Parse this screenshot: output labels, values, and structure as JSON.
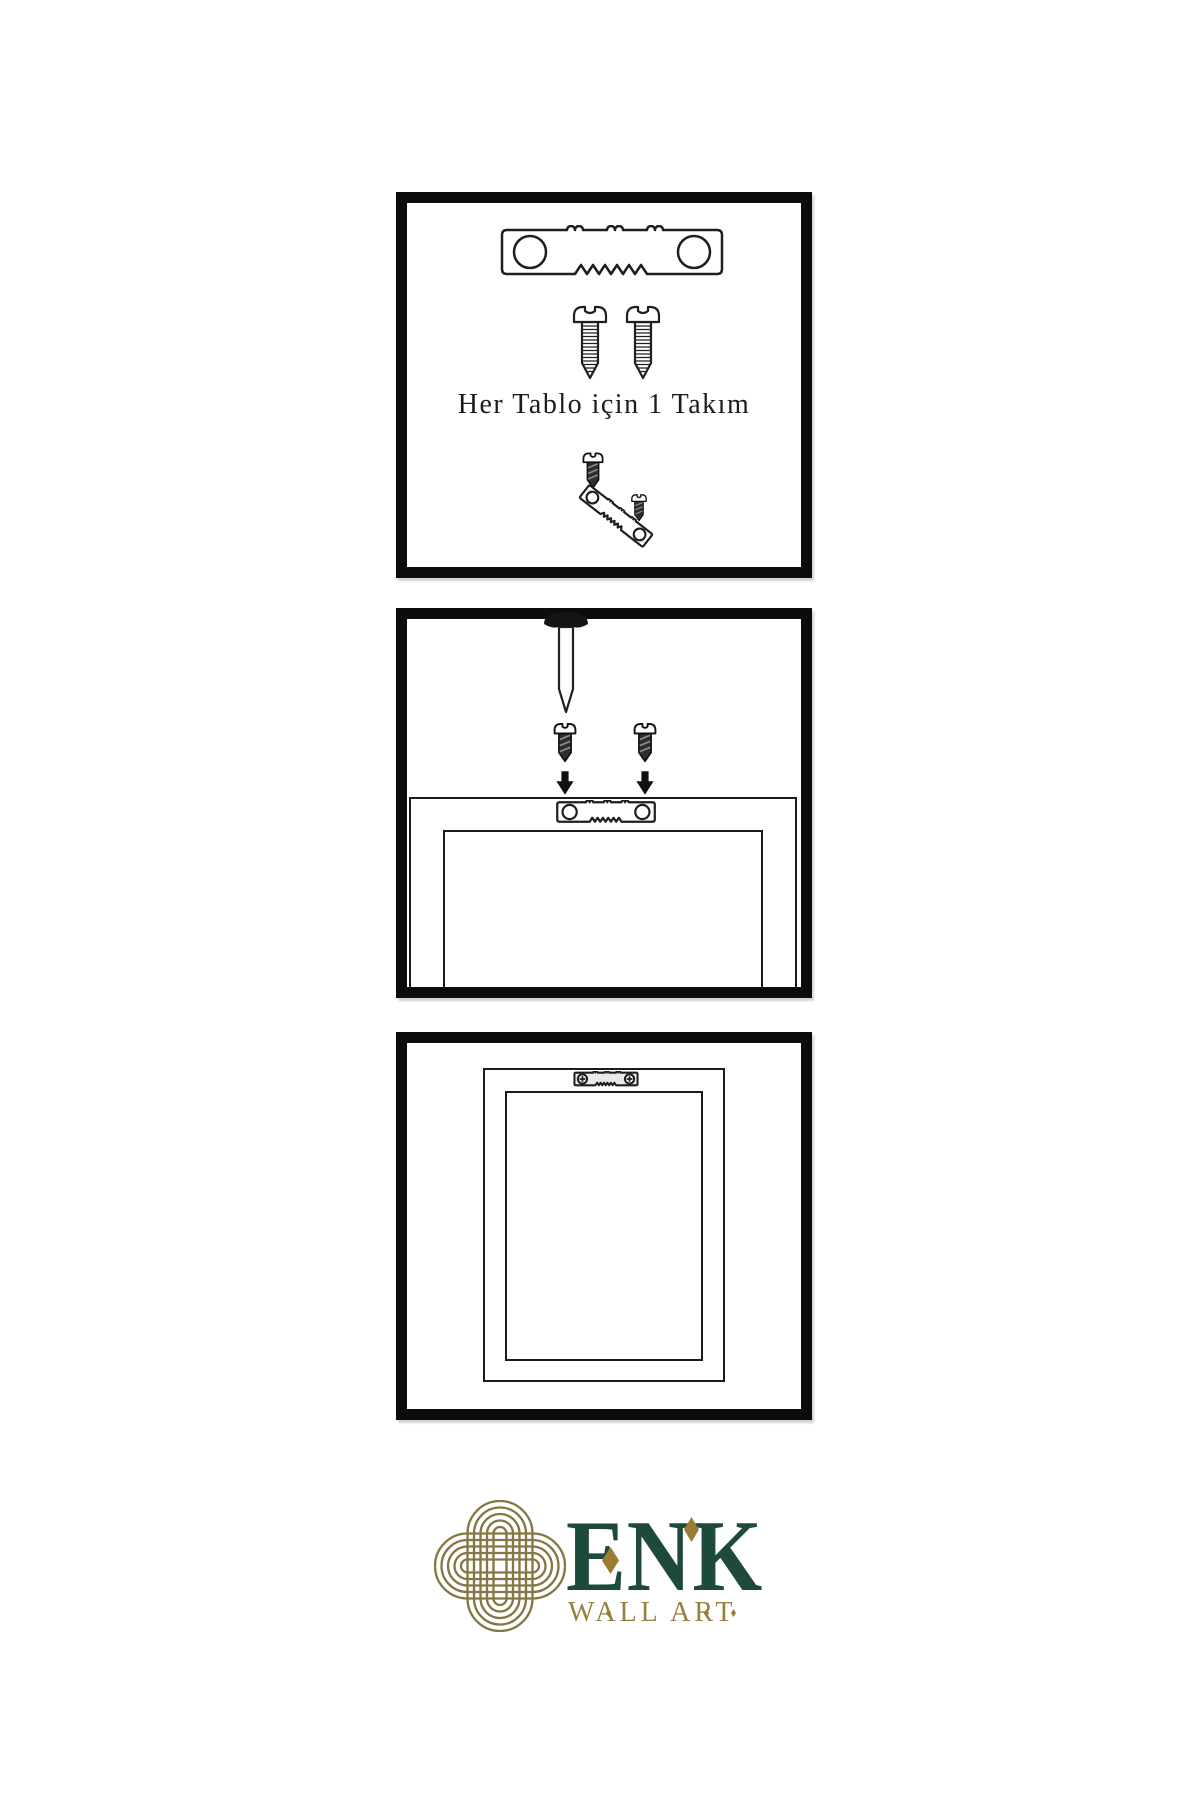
{
  "colors": {
    "background": "#ffffff",
    "panel_border": "#0c0c0c",
    "line_art": "#1f1f1f",
    "screw_dark": "#2e2e2e",
    "brand_green": "#1d4a3c",
    "brand_gold": "#97803f",
    "knot_gold": "#847744",
    "diamond_gold": "#9c7c35"
  },
  "steps": [
    {
      "name": "kit-contents",
      "caption": "Her Tablo için 1 Takım",
      "icons": [
        "sawtooth-hanger-icon",
        "screw-icon",
        "screw-icon",
        "hanger-assembly-icon"
      ]
    },
    {
      "name": "attach-hanger-and-nail",
      "icons": [
        "nail-icon",
        "dark-screw-icon",
        "down-arrow-icon",
        "frame-back-outline",
        "sawtooth-hanger-icon"
      ]
    },
    {
      "name": "frame-hung-on-wall",
      "icons": [
        "frame-outline",
        "mounted-sawtooth-hanger-icon"
      ]
    }
  ],
  "logo": {
    "brand": "ENK",
    "tagline": "WALL ART",
    "icon": "interlaced-knot-icon"
  }
}
